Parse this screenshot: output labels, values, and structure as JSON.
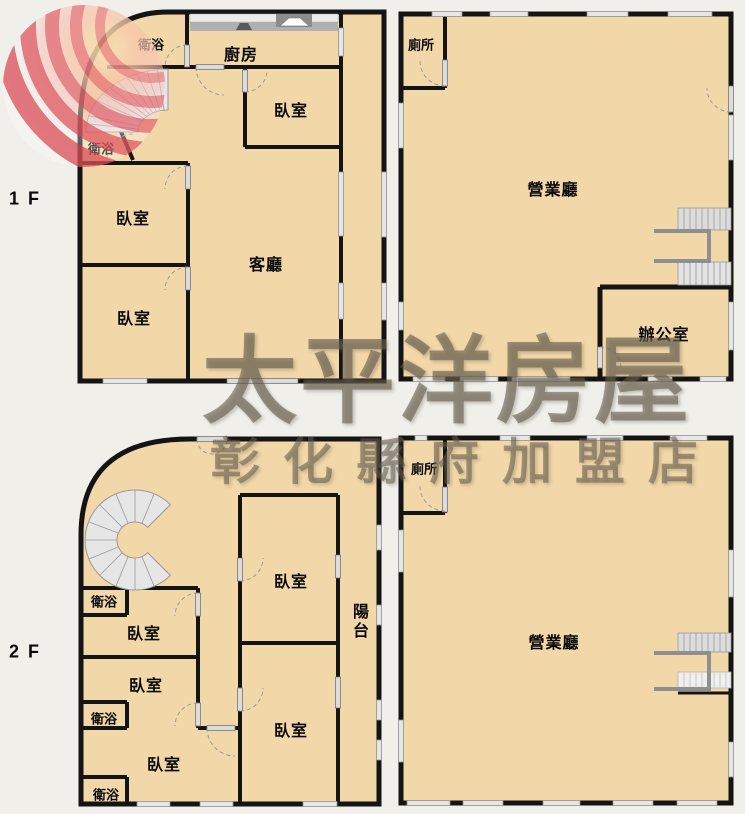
{
  "floor1": {
    "label": "1 F",
    "left": {
      "bath_top": "衛浴",
      "kitchen": "廚房",
      "bedroom_top": "臥室",
      "bath_mid": "衛浴",
      "bedroom_mid": "臥室",
      "bedroom_bottom": "臥室",
      "living": "客廳"
    },
    "right": {
      "toilet": "廁所",
      "hall": "營業廳",
      "office": "辦公室"
    }
  },
  "floor2": {
    "label": "2 F",
    "left": {
      "bath_top": "衛浴",
      "bedroom_1": "臥室",
      "bedroom_2": "臥室",
      "bath_mid": "衛浴",
      "bedroom_3": "臥室",
      "bath_bottom": "衛浴",
      "bedroom_right_top": "臥室",
      "bedroom_right_bottom": "臥室",
      "balcony": "陽台"
    },
    "right": {
      "toilet": "廁所",
      "hall": "營業廳"
    }
  },
  "watermark": {
    "brand": "太平洋房屋",
    "branch": "彰化縣府加盟店"
  },
  "colors": {
    "floor": "#f2d8a8",
    "wall": "#141414",
    "background": "#f0efe9",
    "watermark_text": "#60584a",
    "logo_red": "#e25563"
  }
}
